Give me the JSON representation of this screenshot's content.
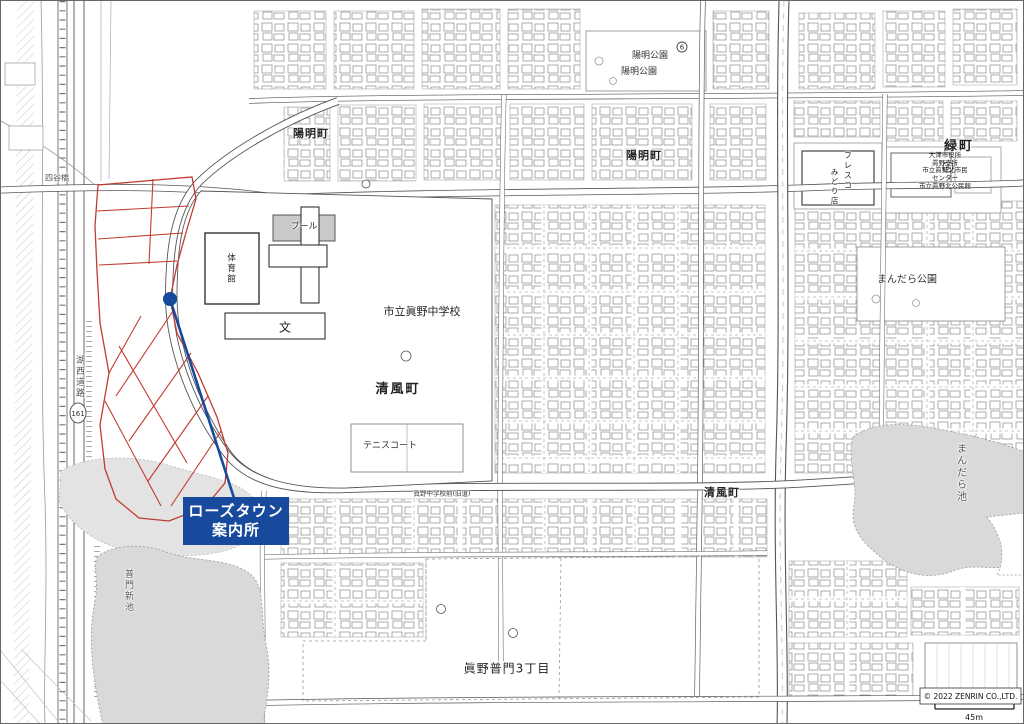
{
  "marker": {
    "line1": "ローズタウン",
    "line2": "案内所"
  },
  "labels": {
    "yomei_cho_west": "陽明町",
    "yomei_cho_east": "陽明町",
    "yomei_park_upper": "陽明公園",
    "yomei_park_lower": "陽明公園",
    "midori_cho": "緑町",
    "civic": [
      "大津市役所",
      "眞野支所",
      "市立眞野北市民",
      "センター",
      "市立眞野北公民館"
    ],
    "fresco_col1": "フレスコ",
    "fresco_col2": "みどり店",
    "mandara_park": "まんだら公園",
    "mandara_pond": "まんだら池",
    "seifu_cho_school": "清風町",
    "seifu_cho_east": "清風町",
    "school": "市立眞野中学校",
    "pool": "プール",
    "gym": "体育館",
    "school_symbol": "文",
    "tennis": "テニスコート",
    "bus_stop": "眞野中学校前(旧道)",
    "fumon_pond": "普門新池",
    "mano_fumon": "眞野普門3丁目",
    "kosei_road": "湖西道路",
    "route_number": "161",
    "bridge": "四谷橋"
  },
  "symbols": {
    "park_number": "6",
    "civic_number": "4"
  },
  "footer": {
    "copyright": "© 2022 ZENRIN CO.,LTD.",
    "scale": "45m"
  },
  "colors": {
    "marker_blue": "#174a9c",
    "plot_red": "#c23b2e",
    "pond_gray": "#d9d9d9"
  }
}
